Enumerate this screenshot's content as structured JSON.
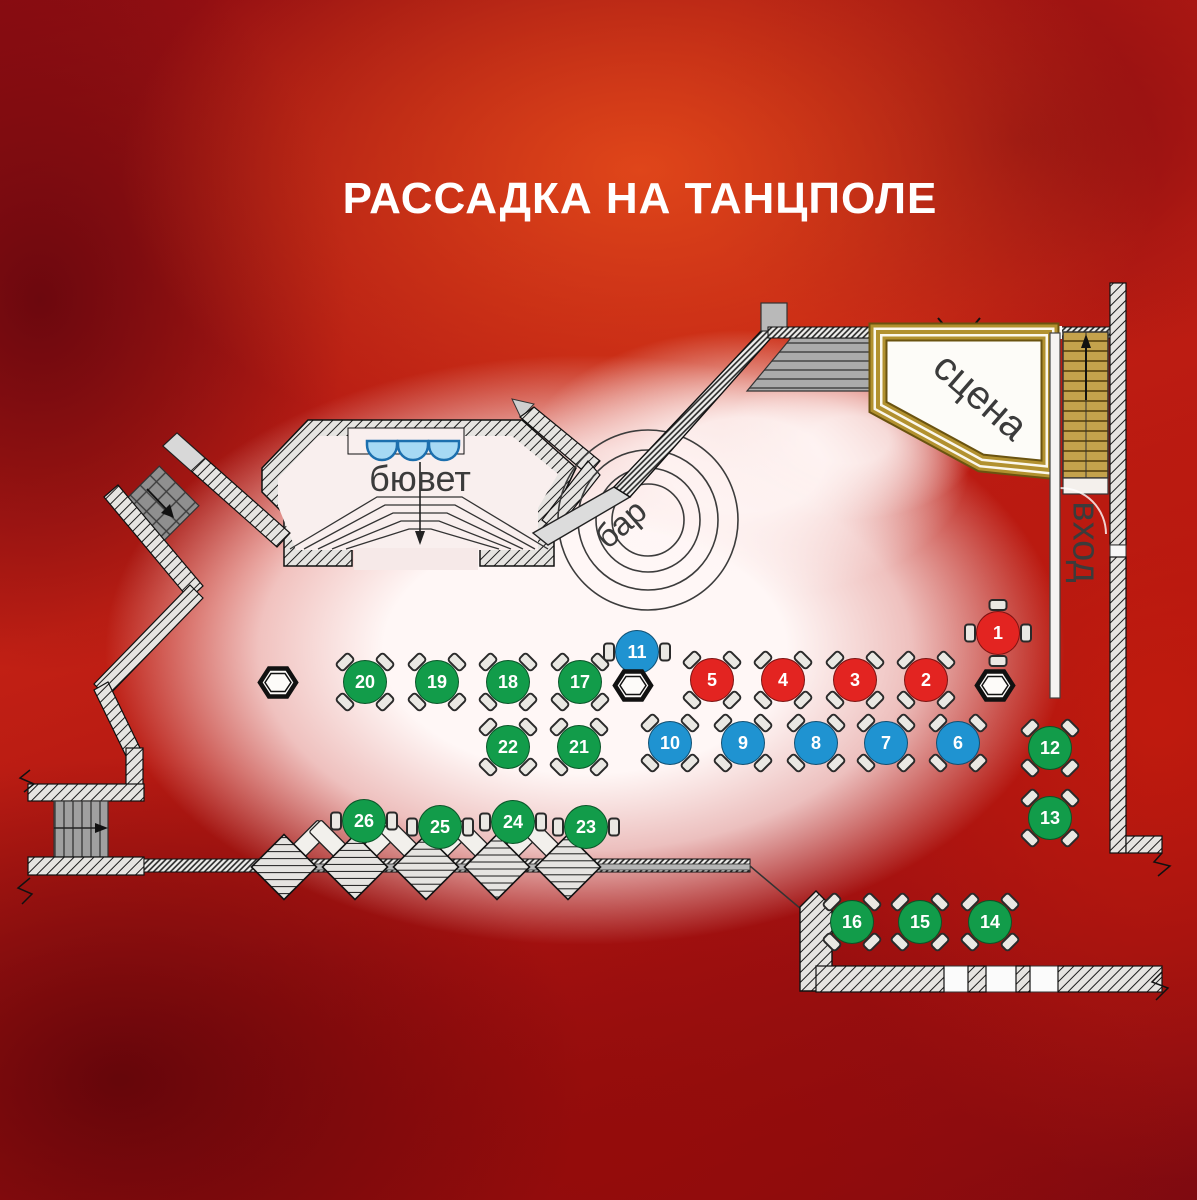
{
  "title": "РАССАДКА НА ТАНЦПОЛЕ",
  "labels": {
    "buffet": "бювет",
    "bar": "бар",
    "stage": "сцена",
    "entrance": "вход"
  },
  "legend_colors": {
    "red": "#e32421",
    "blue": "#1f93d1",
    "green": "#129c4a"
  },
  "style_colors": {
    "chair": "#eae8e3",
    "wall": "#e6e4e1",
    "gold_trim": "#b2912f",
    "stairs_tan": "#c4a24c",
    "label_text": "#3b3b3b",
    "title_text": "#ffffff",
    "bowl_blue": "#a6d9f4"
  },
  "tables": [
    {
      "num": 1,
      "color": "red",
      "x": 998,
      "y": 633,
      "chairs": "cardinal"
    },
    {
      "num": 2,
      "color": "red",
      "x": 926,
      "y": 680,
      "chairs": "diag"
    },
    {
      "num": 3,
      "color": "red",
      "x": 855,
      "y": 680,
      "chairs": "diag"
    },
    {
      "num": 4,
      "color": "red",
      "x": 783,
      "y": 680,
      "chairs": "diag"
    },
    {
      "num": 5,
      "color": "red",
      "x": 712,
      "y": 680,
      "chairs": "diag"
    },
    {
      "num": 6,
      "color": "blue",
      "x": 958,
      "y": 743,
      "chairs": "diag"
    },
    {
      "num": 7,
      "color": "blue",
      "x": 886,
      "y": 743,
      "chairs": "diag"
    },
    {
      "num": 8,
      "color": "blue",
      "x": 816,
      "y": 743,
      "chairs": "diag"
    },
    {
      "num": 9,
      "color": "blue",
      "x": 743,
      "y": 743,
      "chairs": "diag"
    },
    {
      "num": 10,
      "color": "blue",
      "x": 670,
      "y": 743,
      "chairs": "diag"
    },
    {
      "num": 11,
      "color": "blue",
      "x": 637,
      "y": 652,
      "chairs": "sides"
    },
    {
      "num": 12,
      "color": "green",
      "x": 1050,
      "y": 748,
      "chairs": "diag"
    },
    {
      "num": 13,
      "color": "green",
      "x": 1050,
      "y": 818,
      "chairs": "diag"
    },
    {
      "num": 14,
      "color": "green",
      "x": 990,
      "y": 922,
      "chairs": "diag"
    },
    {
      "num": 15,
      "color": "green",
      "x": 920,
      "y": 922,
      "chairs": "diag"
    },
    {
      "num": 16,
      "color": "green",
      "x": 852,
      "y": 922,
      "chairs": "diag"
    },
    {
      "num": 17,
      "color": "green",
      "x": 580,
      "y": 682,
      "chairs": "diag"
    },
    {
      "num": 18,
      "color": "green",
      "x": 508,
      "y": 682,
      "chairs": "diag"
    },
    {
      "num": 19,
      "color": "green",
      "x": 437,
      "y": 682,
      "chairs": "diag"
    },
    {
      "num": 20,
      "color": "green",
      "x": 365,
      "y": 682,
      "chairs": "diag"
    },
    {
      "num": 21,
      "color": "green",
      "x": 579,
      "y": 747,
      "chairs": "diag"
    },
    {
      "num": 22,
      "color": "green",
      "x": 508,
      "y": 747,
      "chairs": "diag"
    },
    {
      "num": 23,
      "color": "green",
      "x": 586,
      "y": 827,
      "chairs": "sides"
    },
    {
      "num": 24,
      "color": "green",
      "x": 513,
      "y": 822,
      "chairs": "sides"
    },
    {
      "num": 25,
      "color": "green",
      "x": 440,
      "y": 827,
      "chairs": "sides"
    },
    {
      "num": 26,
      "color": "green",
      "x": 364,
      "y": 821,
      "chairs": "sides"
    }
  ],
  "columns": [
    {
      "x": 278,
      "y": 685
    },
    {
      "x": 633,
      "y": 688
    },
    {
      "x": 995,
      "y": 688
    }
  ]
}
